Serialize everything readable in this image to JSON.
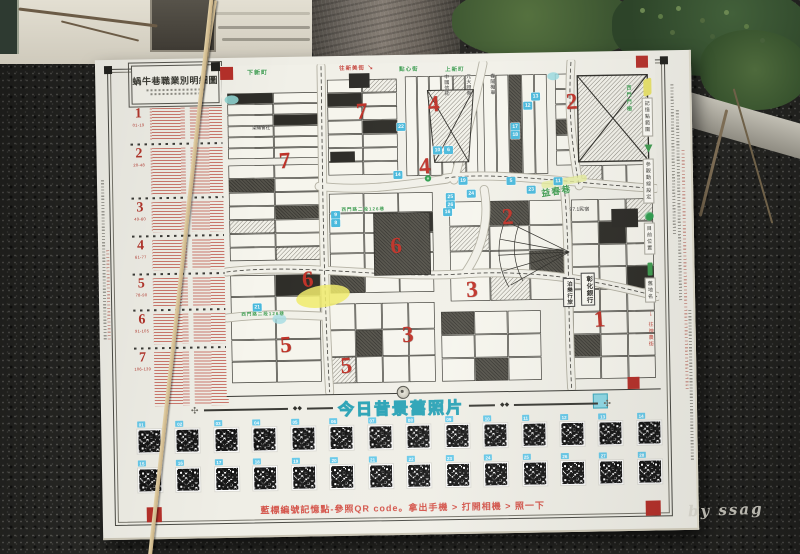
{
  "scene": {
    "watermark": "by ssag"
  },
  "board": {
    "title": "蝸牛巷職業別明細圖",
    "colors": {
      "accent_red": "#c0392f",
      "street_green": "#3f9c50",
      "marker_blue": "#49b9dc",
      "banner_teal": "#3fb0c2",
      "chip_cyan": "#67c9e9",
      "highlight_yellow": "#f0eb6a"
    },
    "legend": {
      "sections": [
        {
          "num": "1",
          "range": "01-19"
        },
        {
          "num": "2",
          "range": "20-48"
        },
        {
          "num": "3",
          "range": "49-60"
        },
        {
          "num": "4",
          "range": "61-77"
        },
        {
          "num": "5",
          "range": "78-90"
        },
        {
          "num": "6",
          "range": "91-105"
        },
        {
          "num": "7",
          "range": "106-139"
        }
      ]
    },
    "map": {
      "zones": [
        {
          "n": "7",
          "x": 62,
          "y": 96
        },
        {
          "n": "7",
          "x": 140,
          "y": 48
        },
        {
          "n": "4",
          "x": 212,
          "y": 42
        },
        {
          "n": "4",
          "x": 202,
          "y": 104
        },
        {
          "n": "2",
          "x": 350,
          "y": 42
        },
        {
          "n": "2",
          "x": 284,
          "y": 156
        },
        {
          "n": "6",
          "x": 172,
          "y": 183
        },
        {
          "n": "6",
          "x": 83,
          "y": 215
        },
        {
          "n": "3",
          "x": 247,
          "y": 228
        },
        {
          "n": "3",
          "x": 182,
          "y": 272
        },
        {
          "n": "5",
          "x": 60,
          "y": 280
        },
        {
          "n": "5",
          "x": 120,
          "y": 302
        },
        {
          "n": "1",
          "x": 374,
          "y": 260
        }
      ],
      "markers": [
        {
          "n": "22",
          "x": 179,
          "y": 64
        },
        {
          "n": "13",
          "x": 314,
          "y": 36
        },
        {
          "n": "12",
          "x": 306,
          "y": 45
        },
        {
          "n": "14",
          "x": 175,
          "y": 112
        },
        {
          "n": "10",
          "x": 215,
          "y": 88
        },
        {
          "n": "6",
          "x": 226,
          "y": 88
        },
        {
          "n": "19",
          "x": 240,
          "y": 119
        },
        {
          "n": "25",
          "x": 227,
          "y": 135
        },
        {
          "n": "26",
          "x": 227,
          "y": 143
        },
        {
          "n": "24",
          "x": 248,
          "y": 132
        },
        {
          "n": "16",
          "x": 224,
          "y": 150
        },
        {
          "n": "5",
          "x": 288,
          "y": 120
        },
        {
          "n": "11",
          "x": 335,
          "y": 121
        },
        {
          "n": "23",
          "x": 308,
          "y": 129
        },
        {
          "n": "9",
          "x": 112,
          "y": 151
        },
        {
          "n": "8",
          "x": 112,
          "y": 159
        },
        {
          "n": "21",
          "x": 32,
          "y": 242
        },
        {
          "n": "17",
          "x": 293,
          "y": 66
        },
        {
          "n": "18",
          "x": 293,
          "y": 74
        }
      ],
      "streets": [
        {
          "label": "下新町",
          "x": 26,
          "y": 2,
          "color": "green",
          "size": 6
        },
        {
          "label": "往新美街",
          "x": 118,
          "y": 0,
          "color": "red",
          "size": 5.5
        },
        {
          "label": "點心街",
          "x": 178,
          "y": 2,
          "color": "green",
          "size": 5.5
        },
        {
          "label": "上新町",
          "x": 224,
          "y": 3,
          "color": "green",
          "size": 5.5
        },
        {
          "label": "西門路二段126巷",
          "x": 118,
          "y": 143,
          "color": "green",
          "size": 4.5
        },
        {
          "label": "西門路二段126巷",
          "x": 16,
          "y": 246,
          "color": "green",
          "size": 4.5
        },
        {
          "label": "益春巷",
          "x": 318,
          "y": 124,
          "color": "green",
          "size": 9,
          "rotate": -8
        },
        {
          "label": "西門門柵",
          "x": 404,
          "y": 26,
          "color": "green",
          "size": 5,
          "vertical": true
        }
      ],
      "pois": [
        {
          "label": "彰化銀行",
          "x": 356,
          "y": 213,
          "vertical": true,
          "boxed": true,
          "size": 6.5
        },
        {
          "label": "泊樂行旅",
          "x": 338,
          "y": 218,
          "vertical": true,
          "boxed": true,
          "size": 5.5
        },
        {
          "label": "97.1民宿",
          "x": 346,
          "y": 146,
          "size": 5
        },
        {
          "label": "中國信託",
          "x": 222,
          "y": 12,
          "vertical": true,
          "size": 5
        },
        {
          "label": "元大證券",
          "x": 244,
          "y": 12,
          "vertical": true,
          "size": 5
        },
        {
          "label": "春陽機車",
          "x": 268,
          "y": 12,
          "vertical": true,
          "size": 5
        },
        {
          "label": "染織會社",
          "x": 30,
          "y": 60,
          "size": 4.5
        }
      ],
      "side_legend": [
        {
          "icon": "yellow-swatch",
          "label": "記憶點範圍"
        },
        {
          "icon": "route-arrow",
          "label": "參觀動線設定"
        },
        {
          "icon": "location-dot",
          "label": "目前位置"
        },
        {
          "icon": "oldname-bar",
          "label": "舊地名"
        },
        {
          "icon": "to-street-arrow",
          "label": "往神農街"
        }
      ]
    },
    "banner": {
      "title": "今日昔景舊照片"
    },
    "qr_labels": [
      "01",
      "02",
      "03",
      "04",
      "05",
      "06",
      "07",
      "08",
      "09",
      "10",
      "11",
      "12",
      "13",
      "14",
      "15",
      "16",
      "17",
      "18",
      "19",
      "20",
      "21",
      "22",
      "23",
      "24",
      "25",
      "26",
      "27",
      "28"
    ],
    "footer_note": "藍標編號記憶點-參照QR code。拿出手機 > 打開相機 > 照一下"
  }
}
